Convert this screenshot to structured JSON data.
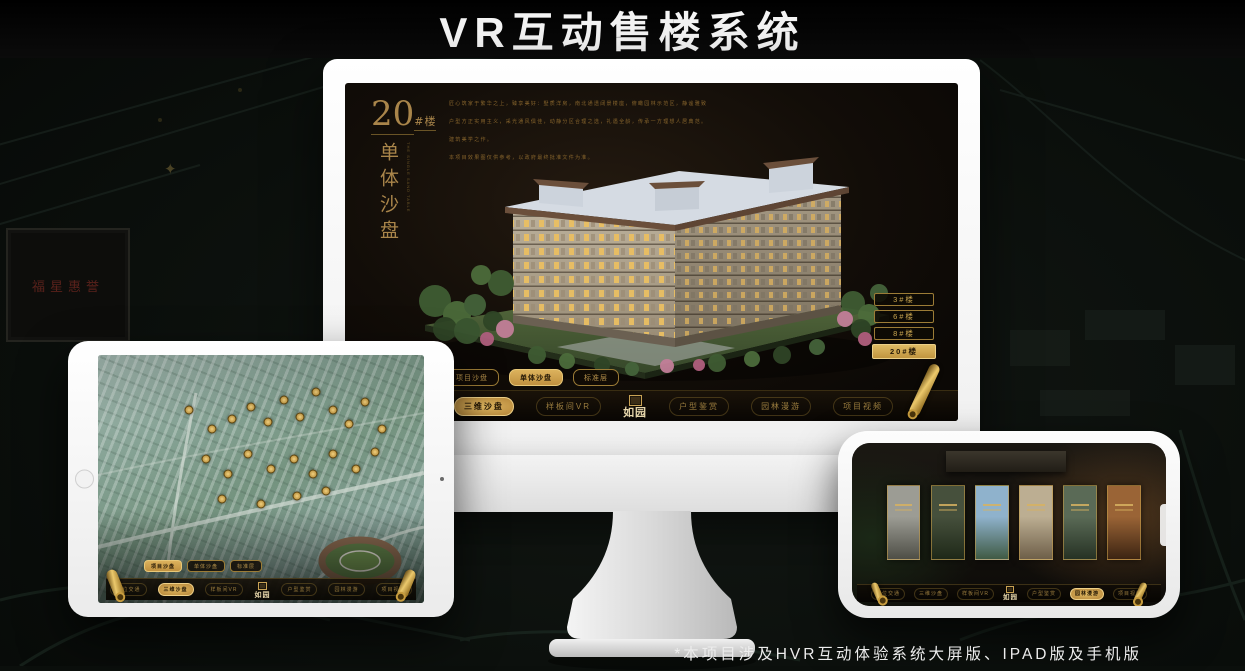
{
  "page": {
    "title": "VR互动售楼系统",
    "footnote": "*本项目涉及HVR互动体验系统大屏版、IPAD版及手机版"
  },
  "background": {
    "plaque_text": "福星惠誉",
    "compass_glyph": "✦"
  },
  "logo": {
    "text": "如园"
  },
  "colors": {
    "gold": "#c9a45c",
    "gold_bright": "#e8c878",
    "gold_dim": "#8a6c34",
    "screen_dark": "#141008",
    "active_tab_bg": "#c79a44",
    "bezel_white": "#f5f5f5"
  },
  "monitor_app": {
    "heading": {
      "number": "20",
      "suffix": "#楼",
      "title_vertical": "单体沙盘",
      "subtitle_en": "THE SINGLE SAND TABLE"
    },
    "description_lines": [
      "匠心筑家于繁华之上，臻享美好：墅质洋房，南北通透阔景楼座，俯瞰园林示范区，静谧雅致",
      "户型方正实用主义，采光通风俱佳，动静分区合理之选，礼遇全龄，传承一方理想人居典范。",
      "建筑美学之作。",
      "本项目效果图仅供参考，以政府最终批准文件为准。"
    ],
    "tabs": [
      {
        "label": "项目沙盘",
        "active": false
      },
      {
        "label": "单体沙盘",
        "active": true
      },
      {
        "label": "标准层",
        "active": false
      }
    ],
    "floor_buttons": [
      {
        "label": "3#楼",
        "active": false
      },
      {
        "label": "6#楼",
        "active": false
      },
      {
        "label": "8#楼",
        "active": false
      },
      {
        "label": "20#楼",
        "active": true
      }
    ],
    "menu": {
      "items": [
        {
          "label": "区位交通",
          "active": false
        },
        {
          "label": "三维沙盘",
          "active": true
        },
        {
          "label": "样板间VR",
          "active": false
        },
        {
          "label": "户型鉴赏",
          "active": false
        },
        {
          "label": "园林漫游",
          "active": false
        },
        {
          "label": "项目视频",
          "active": false
        }
      ]
    }
  },
  "ipad_app": {
    "tabs": [
      {
        "label": "项目沙盘",
        "active": true
      },
      {
        "label": "单体沙盘",
        "active": false
      },
      {
        "label": "标准层",
        "active": false
      }
    ],
    "menu": {
      "items": [
        {
          "label": "区位交通",
          "active": false
        },
        {
          "label": "三维沙盘",
          "active": true
        },
        {
          "label": "样板间VR",
          "active": false
        },
        {
          "label": "户型鉴赏",
          "active": false
        },
        {
          "label": "园林漫游",
          "active": false
        },
        {
          "label": "项目视频",
          "active": false
        }
      ]
    },
    "badges": [
      [
        28,
        22
      ],
      [
        35,
        30
      ],
      [
        41,
        26
      ],
      [
        47,
        21
      ],
      [
        52,
        27
      ],
      [
        57,
        18
      ],
      [
        62,
        25
      ],
      [
        67,
        15
      ],
      [
        72,
        22
      ],
      [
        77,
        28
      ],
      [
        82,
        19
      ],
      [
        87,
        30
      ],
      [
        33,
        42
      ],
      [
        40,
        48
      ],
      [
        46,
        40
      ],
      [
        53,
        46
      ],
      [
        60,
        42
      ],
      [
        66,
        48
      ],
      [
        72,
        40
      ],
      [
        79,
        46
      ],
      [
        85,
        39
      ],
      [
        38,
        58
      ],
      [
        50,
        60
      ],
      [
        61,
        57
      ],
      [
        70,
        55
      ]
    ]
  },
  "phone_app": {
    "menu": {
      "items": [
        {
          "label": "区位交通",
          "active": false
        },
        {
          "label": "三维沙盘",
          "active": false
        },
        {
          "label": "样板间VR",
          "active": false
        },
        {
          "label": "户型鉴赏",
          "active": false
        },
        {
          "label": "园林漫游",
          "active": true
        },
        {
          "label": "项目视频",
          "active": false
        }
      ]
    },
    "panels": [
      {
        "name": "courtyard-gray",
        "top": "#9c9c94",
        "bottom": "#4e4e46"
      },
      {
        "name": "interior-green",
        "top": "#46503c",
        "bottom": "#1e2818"
      },
      {
        "name": "sky-building",
        "top": "#8fb2cc",
        "bottom": "#3f5a44"
      },
      {
        "name": "beige-facade",
        "top": "#bcae92",
        "bottom": "#6e5f49"
      },
      {
        "name": "garden",
        "top": "#5a6a56",
        "bottom": "#263224"
      },
      {
        "name": "warm-interior",
        "top": "#9a6436",
        "bottom": "#3c2412"
      }
    ]
  }
}
